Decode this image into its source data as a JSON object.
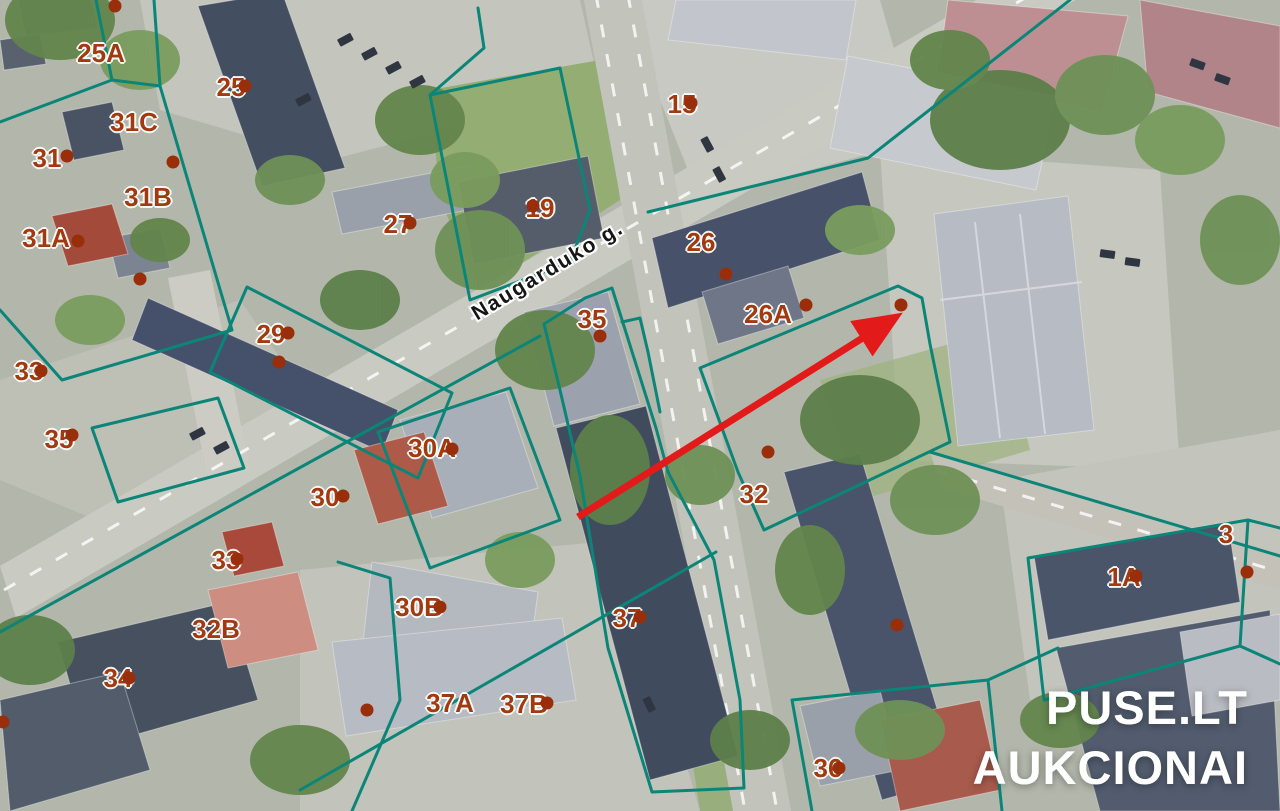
{
  "screen": {
    "width": 1280,
    "height": 811
  },
  "map": {
    "street_name": "Naugarduko g.",
    "colors": {
      "boundary": "#0b8578",
      "label": "#a23a10",
      "dot": "#992e0b",
      "arrow": "#e31a1a",
      "watermark": "#ffffff"
    },
    "parcel_labels": [
      {
        "text": "25A",
        "x": 101,
        "y": 53
      },
      {
        "text": "25",
        "x": 231,
        "y": 87
      },
      {
        "text": "31C",
        "x": 134,
        "y": 122
      },
      {
        "text": "31",
        "x": 47,
        "y": 158
      },
      {
        "text": "31B",
        "x": 148,
        "y": 197
      },
      {
        "text": "31A",
        "x": 46,
        "y": 238
      },
      {
        "text": "15",
        "x": 682,
        "y": 104
      },
      {
        "text": "19",
        "x": 540,
        "y": 208
      },
      {
        "text": "27",
        "x": 398,
        "y": 224
      },
      {
        "text": "26",
        "x": 701,
        "y": 242
      },
      {
        "text": "26A",
        "x": 768,
        "y": 314
      },
      {
        "text": "35",
        "x": 592,
        "y": 319
      },
      {
        "text": "29",
        "x": 271,
        "y": 334
      },
      {
        "text": "33",
        "x": 29,
        "y": 371
      },
      {
        "text": "35",
        "x": 59,
        "y": 439
      },
      {
        "text": "30A",
        "x": 432,
        "y": 448
      },
      {
        "text": "30",
        "x": 325,
        "y": 497
      },
      {
        "text": "32",
        "x": 754,
        "y": 494
      },
      {
        "text": "33",
        "x": 226,
        "y": 560
      },
      {
        "text": "3",
        "x": 1226,
        "y": 534
      },
      {
        "text": "1A",
        "x": 1124,
        "y": 577
      },
      {
        "text": "30B",
        "x": 419,
        "y": 607
      },
      {
        "text": "37",
        "x": 627,
        "y": 618
      },
      {
        "text": "32B",
        "x": 216,
        "y": 629
      },
      {
        "text": "34",
        "x": 118,
        "y": 678
      },
      {
        "text": "37A",
        "x": 450,
        "y": 703
      },
      {
        "text": "37B",
        "x": 524,
        "y": 704
      },
      {
        "text": "36",
        "x": 828,
        "y": 768
      }
    ],
    "dots": [
      {
        "x": 115,
        "y": 6
      },
      {
        "x": 245,
        "y": 86
      },
      {
        "x": 67,
        "y": 156
      },
      {
        "x": 173,
        "y": 162
      },
      {
        "x": 78,
        "y": 241
      },
      {
        "x": 140,
        "y": 279
      },
      {
        "x": 691,
        "y": 103
      },
      {
        "x": 533,
        "y": 206
      },
      {
        "x": 410,
        "y": 223
      },
      {
        "x": 726,
        "y": 274
      },
      {
        "x": 806,
        "y": 305
      },
      {
        "x": 901,
        "y": 305
      },
      {
        "x": 288,
        "y": 333
      },
      {
        "x": 600,
        "y": 336
      },
      {
        "x": 279,
        "y": 362
      },
      {
        "x": 41,
        "y": 371
      },
      {
        "x": 72,
        "y": 435
      },
      {
        "x": 452,
        "y": 449
      },
      {
        "x": 343,
        "y": 496
      },
      {
        "x": 768,
        "y": 452
      },
      {
        "x": 237,
        "y": 559
      },
      {
        "x": 1136,
        "y": 576
      },
      {
        "x": 1247,
        "y": 572
      },
      {
        "x": 440,
        "y": 607
      },
      {
        "x": 640,
        "y": 617
      },
      {
        "x": 129,
        "y": 678
      },
      {
        "x": 3,
        "y": 722
      },
      {
        "x": 367,
        "y": 710
      },
      {
        "x": 547,
        "y": 703
      },
      {
        "x": 897,
        "y": 625
      },
      {
        "x": 839,
        "y": 768
      }
    ],
    "arrow": {
      "x1": 578,
      "y1": 517,
      "x2": 888,
      "y2": 322
    }
  },
  "watermark": {
    "line1": "PUSE.LT",
    "line2": "AUKCIONAI"
  }
}
